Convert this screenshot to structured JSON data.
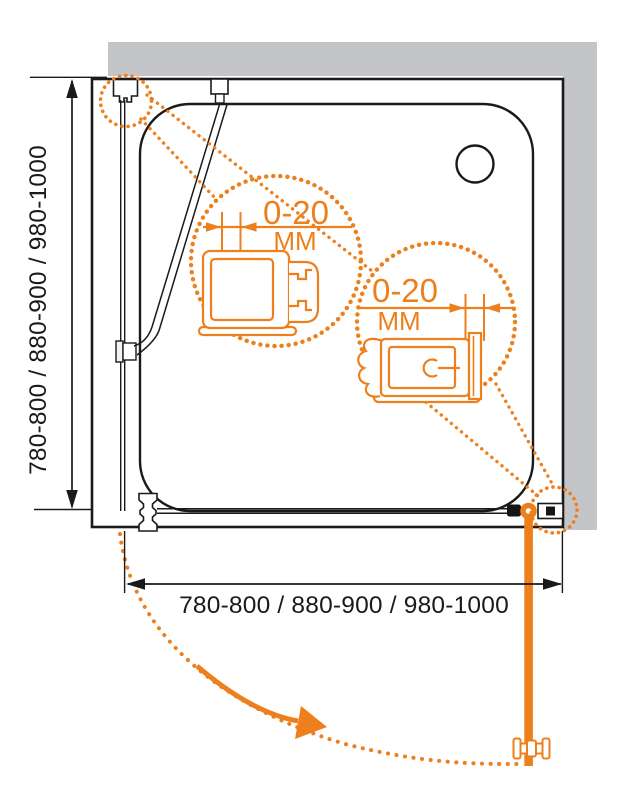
{
  "colors": {
    "accent": "#EE7F1D",
    "wall_gray": "#C3C5C8",
    "ink": "#1A1A1A"
  },
  "dimensions": {
    "height_label": "780-800 / 880-900 / 980-1000",
    "width_label": "780-800 / 880-900 / 980-1000"
  },
  "details": [
    {
      "value": "0-20",
      "unit": "ММ"
    },
    {
      "value": "0-20",
      "unit": "ММ"
    }
  ]
}
